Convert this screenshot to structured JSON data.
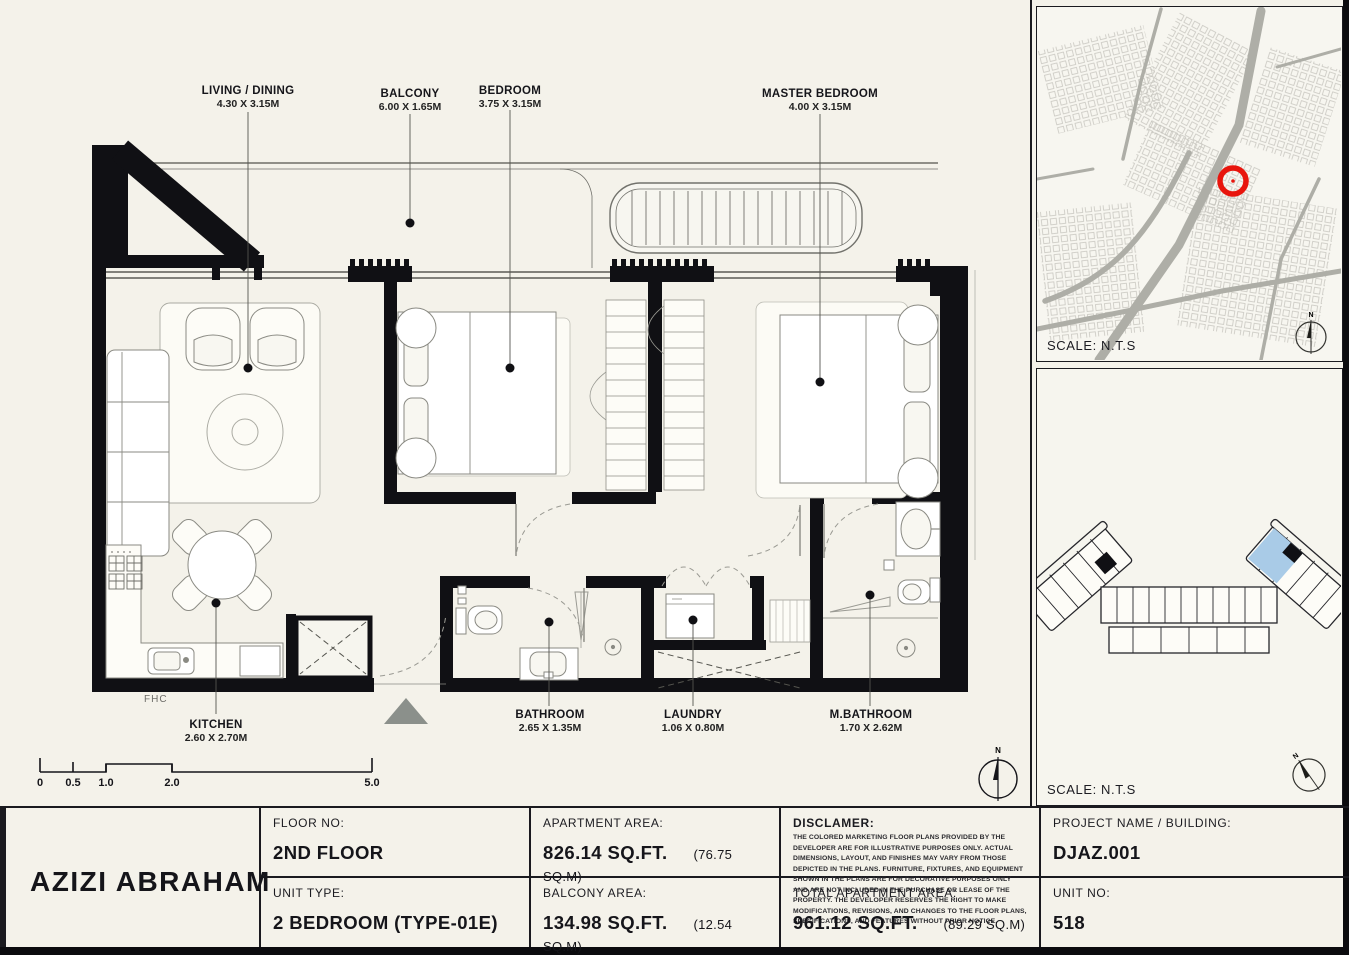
{
  "plan": {
    "room_labels": [
      {
        "name": "LIVING / DINING",
        "dims": "4.30 X 3.15M"
      },
      {
        "name": "BALCONY",
        "dims": "6.00 X 1.65M"
      },
      {
        "name": "BEDROOM",
        "dims": "3.75 X 3.15M"
      },
      {
        "name": "MASTER BEDROOM",
        "dims": "4.00 X 3.15M"
      },
      {
        "name": "KITCHEN",
        "dims": "2.60 X 2.70M"
      },
      {
        "name": "BATHROOM",
        "dims": "2.65 X 1.35M"
      },
      {
        "name": "LAUNDRY",
        "dims": "1.06 X 0.80M"
      },
      {
        "name": "M.BATHROOM",
        "dims": "1.70 X 2.62M"
      }
    ],
    "fhc_label": "FHC",
    "scale_ticks": [
      "0",
      "0.5",
      "1.0",
      "2.0",
      "5.0"
    ],
    "compass_letter": "N"
  },
  "map_panel": {
    "scale_note": "SCALE: N.T.S",
    "marker_color": "#e8150d",
    "compass_letter": "N"
  },
  "keyplan_panel": {
    "scale_note": "SCALE: N.T.S",
    "highlight_color": "#a9cbe7",
    "compass_letter": "N"
  },
  "title_block": {
    "brand": "AZIZI ABRAHAM",
    "floor_no_label": "FLOOR NO:",
    "floor_no": "2ND FLOOR",
    "unit_type_label": "UNIT TYPE:",
    "unit_type": "2 BEDROOM (TYPE-01E)",
    "apartment_area_label": "APARTMENT AREA:",
    "apartment_area": "826.14 SQ.FT.",
    "apartment_area_m": "(76.75 SQ.M)",
    "balcony_area_label": "BALCONY AREA:",
    "balcony_area": "134.98 SQ.FT.",
    "balcony_area_m": "(12.54 SQ.M)",
    "disclaimer_label": "DISCLAMER:",
    "disclaimer_text": "THE COLORED MARKETING FLOOR PLANS PROVIDED BY THE DEVELOPER ARE FOR ILLUSTRATIVE PURPOSES ONLY. ACTUAL DIMENSIONS, LAYOUT, AND FINISHES MAY VARY FROM THOSE DEPICTED IN THE PLANS. FURNITURE, FIXTURES, AND EQUIPMENT SHOWN IN THE PLANS ARE FOR DECORATIVE PURPOSES ONLY AND ARE NOT INCLUDED IN THE PURCHASE OR LEASE OF THE PROPERTY. THE DEVELOPER RESERVES THE RIGHT TO MAKE MODIFICATIONS, REVISIONS, AND CHANGES TO THE FLOOR PLANS, SPECIFICATIONS, AND FEATURES WITHOUT PRIOR NOTICE.",
    "total_area_label": "TOTAL APARTMENT AREA:",
    "total_area": "961.12 SQ.FT.",
    "total_area_m": "(89.29 SQ.M)",
    "project_label": "PROJECT NAME / BUILDING:",
    "project": "DJAZ.001",
    "unit_no_label": "UNIT NO:",
    "unit_no": "518"
  }
}
